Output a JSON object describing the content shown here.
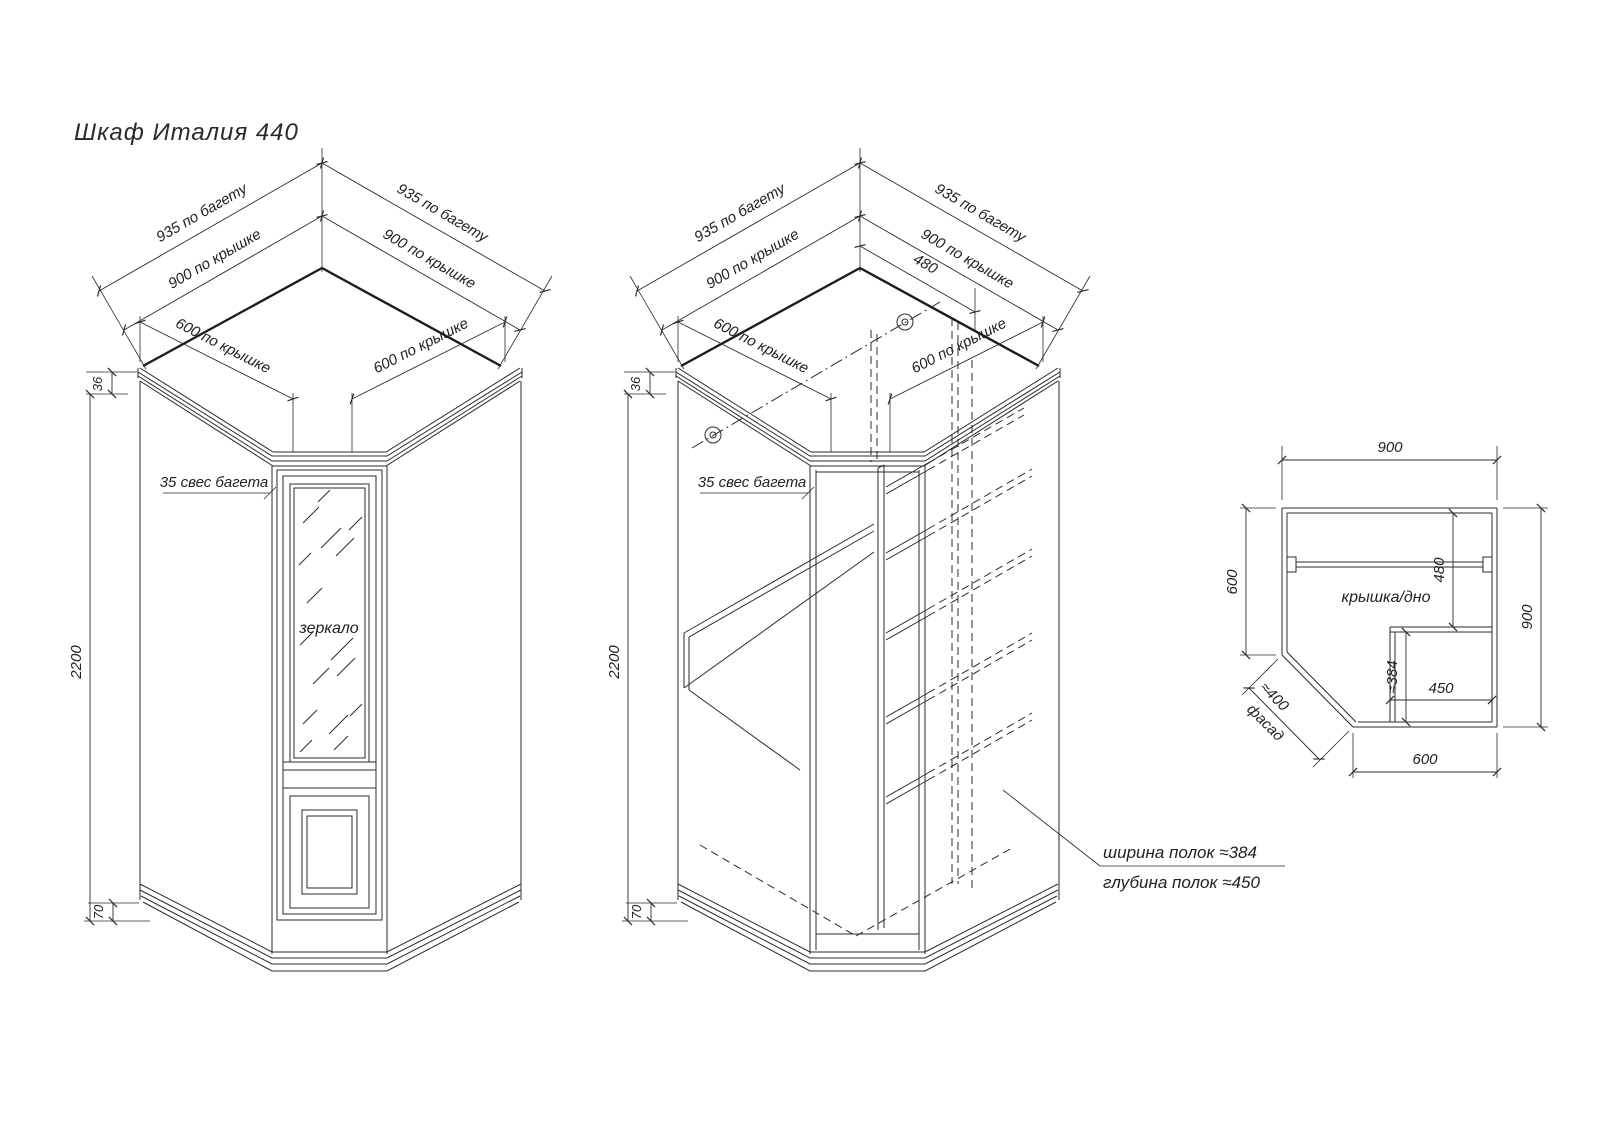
{
  "title": "Шкаф Италия 440",
  "colors": {
    "line": "#2b2b2b",
    "background": "#ffffff"
  },
  "dims": {
    "baguette": "935 по багету",
    "top": "900 по крышке",
    "side": "600 по крышке",
    "height": "2200",
    "crown": "36",
    "plinth": "70",
    "overhang": "35 свес багета",
    "divider_offset": "480"
  },
  "labels": {
    "mirror": "зеркало",
    "shelf_width": "ширина полок ≈384",
    "shelf_depth": "глубина полок ≈450"
  },
  "plan": {
    "top": "900",
    "left": "600",
    "right": "900",
    "depth": "480",
    "shelf_w": "≈384",
    "shelf_d": "450",
    "bottom": "600",
    "facade_len": "≈400",
    "facade_label": "фасад",
    "panel_label": "крышка/дно"
  }
}
